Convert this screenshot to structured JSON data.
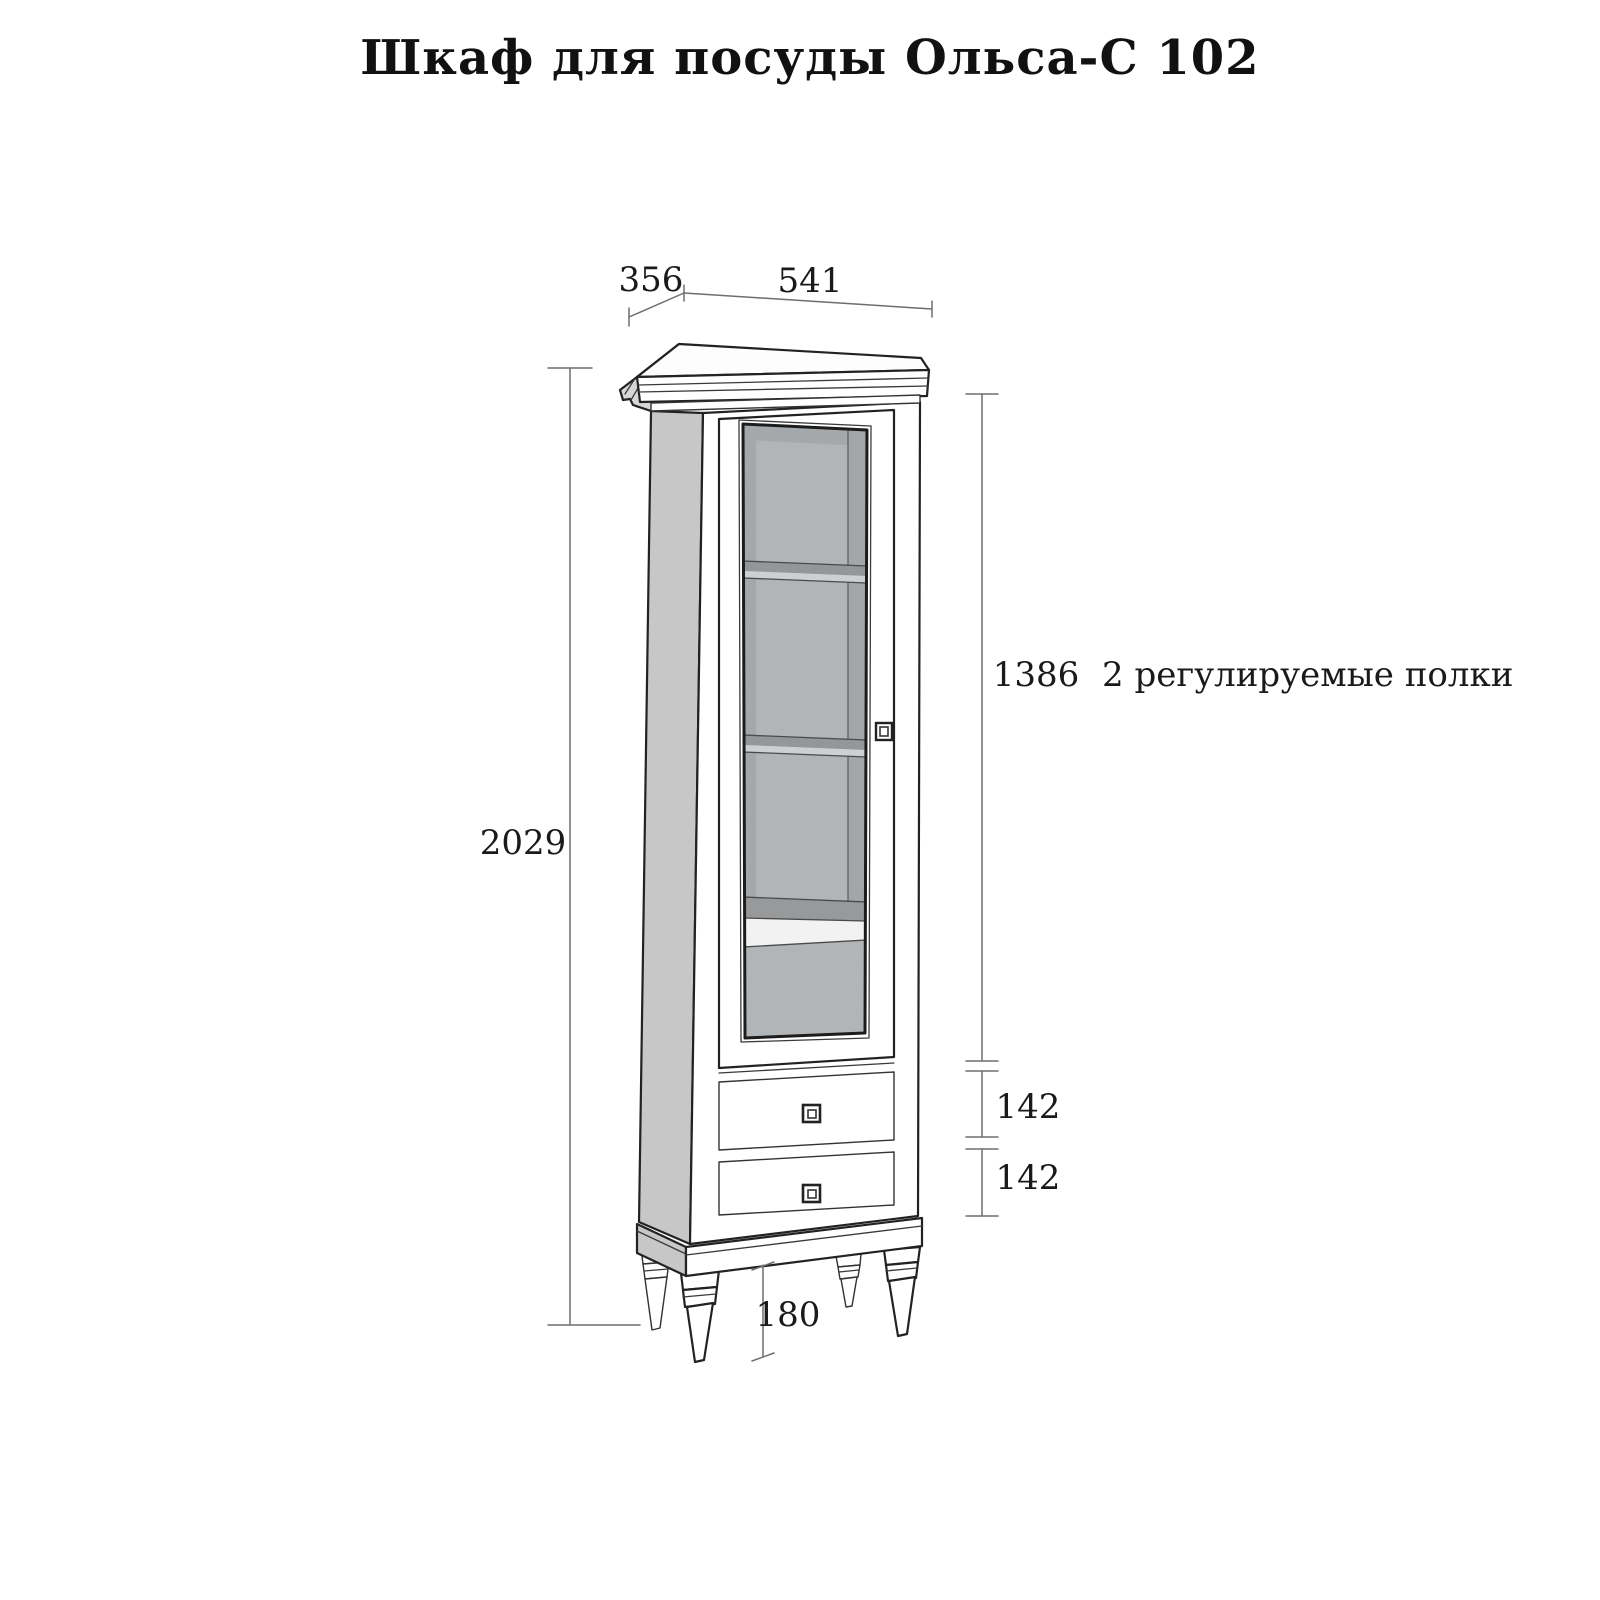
{
  "title": "Шкаф для посуды Ольса-С 102",
  "dimensions": {
    "depth": "356",
    "width": "541",
    "height": "2029",
    "glass_section": "1386",
    "top_drawer": "142",
    "bottom_drawer": "142",
    "legs": "180"
  },
  "note": "2 регулируемые полки",
  "features": {
    "adjustable_shelves_count": "2",
    "drawers_count": "2"
  },
  "colors": {
    "background": "#ffffff",
    "outline": "#222222",
    "dimension_line": "#6e6e6e",
    "label_text": "#1a1a1a",
    "side_panel": "#c7c7c7",
    "crown_side": "#d6d6d6",
    "glass": "#b2b5b7",
    "glass_shadow": "#a5a8aa",
    "glass_inner_wall": "#a3a6a8",
    "shelf_band": "#94979a",
    "shelf_highlight": "#ccd0d1",
    "fixed_shelf_top": "#97999b",
    "white_part": "#ffffff"
  }
}
